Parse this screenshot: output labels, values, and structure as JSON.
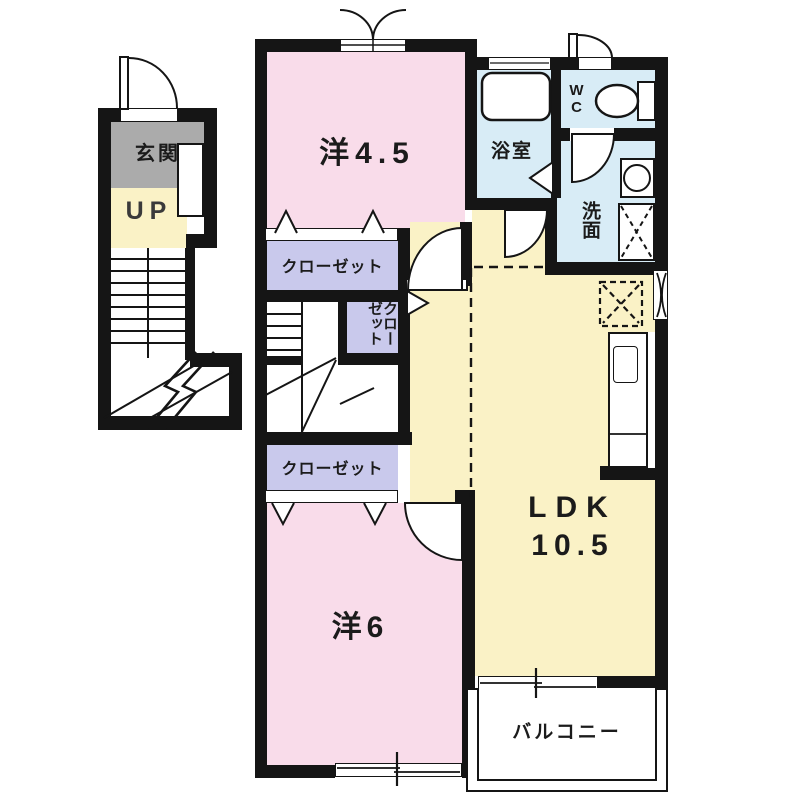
{
  "plan": {
    "type": "apartment-floor-plan-2F",
    "rooms": {
      "entrance": {
        "label": "玄関"
      },
      "stairs": {
        "label": "UP"
      },
      "western_room_45": {
        "label": "洋4.5"
      },
      "closet_upper": {
        "label": "クローゼット"
      },
      "closet_side_vertical": {
        "label": "クローゼット"
      },
      "closet_lower": {
        "label": "クローゼット"
      },
      "bathroom": {
        "label": "浴室"
      },
      "toilet": {
        "label": "WC"
      },
      "washroom": {
        "label": "洗面"
      },
      "ldk": {
        "label": "LDK",
        "size": "10.5"
      },
      "western_room_6": {
        "label": "洋6"
      },
      "balcony": {
        "label": "バルコニー"
      }
    },
    "colors": {
      "room_pink": "#f9dcea",
      "room_cream": "#faf2c6",
      "room_blue": "#d8ecf6",
      "closet_lavender": "#c9c9ec",
      "entrance_gray": "#ababab",
      "wall_black": "#151515",
      "text": "#1b1b1b"
    }
  }
}
